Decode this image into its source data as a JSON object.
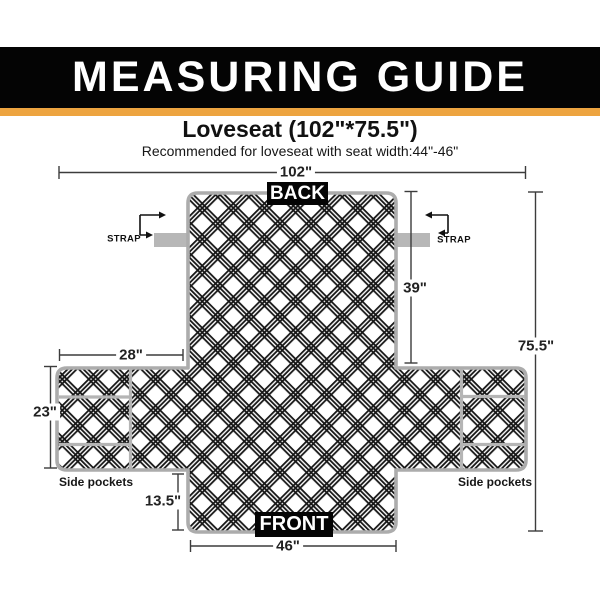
{
  "header": {
    "title": "MEASURING GUIDE"
  },
  "product": {
    "name": "Loveseat (102\"*75.5\")",
    "recommendation": "Recommended for loveseat with seat width:44\"-46\""
  },
  "diagram": {
    "back_label": "BACK",
    "front_label": "FRONT",
    "strap_left": "STRAP",
    "strap_right": "STRAP",
    "pockets_left": "Side pockets",
    "pockets_right": "Side pockets",
    "dimensions": {
      "overall_width": "102\"",
      "overall_height": "75.5\"",
      "back_height": "39\"",
      "arm_panel_width": "28\"",
      "arm_panel_height": "23\"",
      "front_skirt_height": "13.5\"",
      "front_width": "46\""
    }
  },
  "colors": {
    "header_bg": "#040404",
    "accent_gold": "#EDA440",
    "outline_gray": "#ACACAC",
    "strap_gray": "#B7B7B7",
    "hatch_dark": "#161616",
    "dimension_line": "#3C3C3C"
  }
}
